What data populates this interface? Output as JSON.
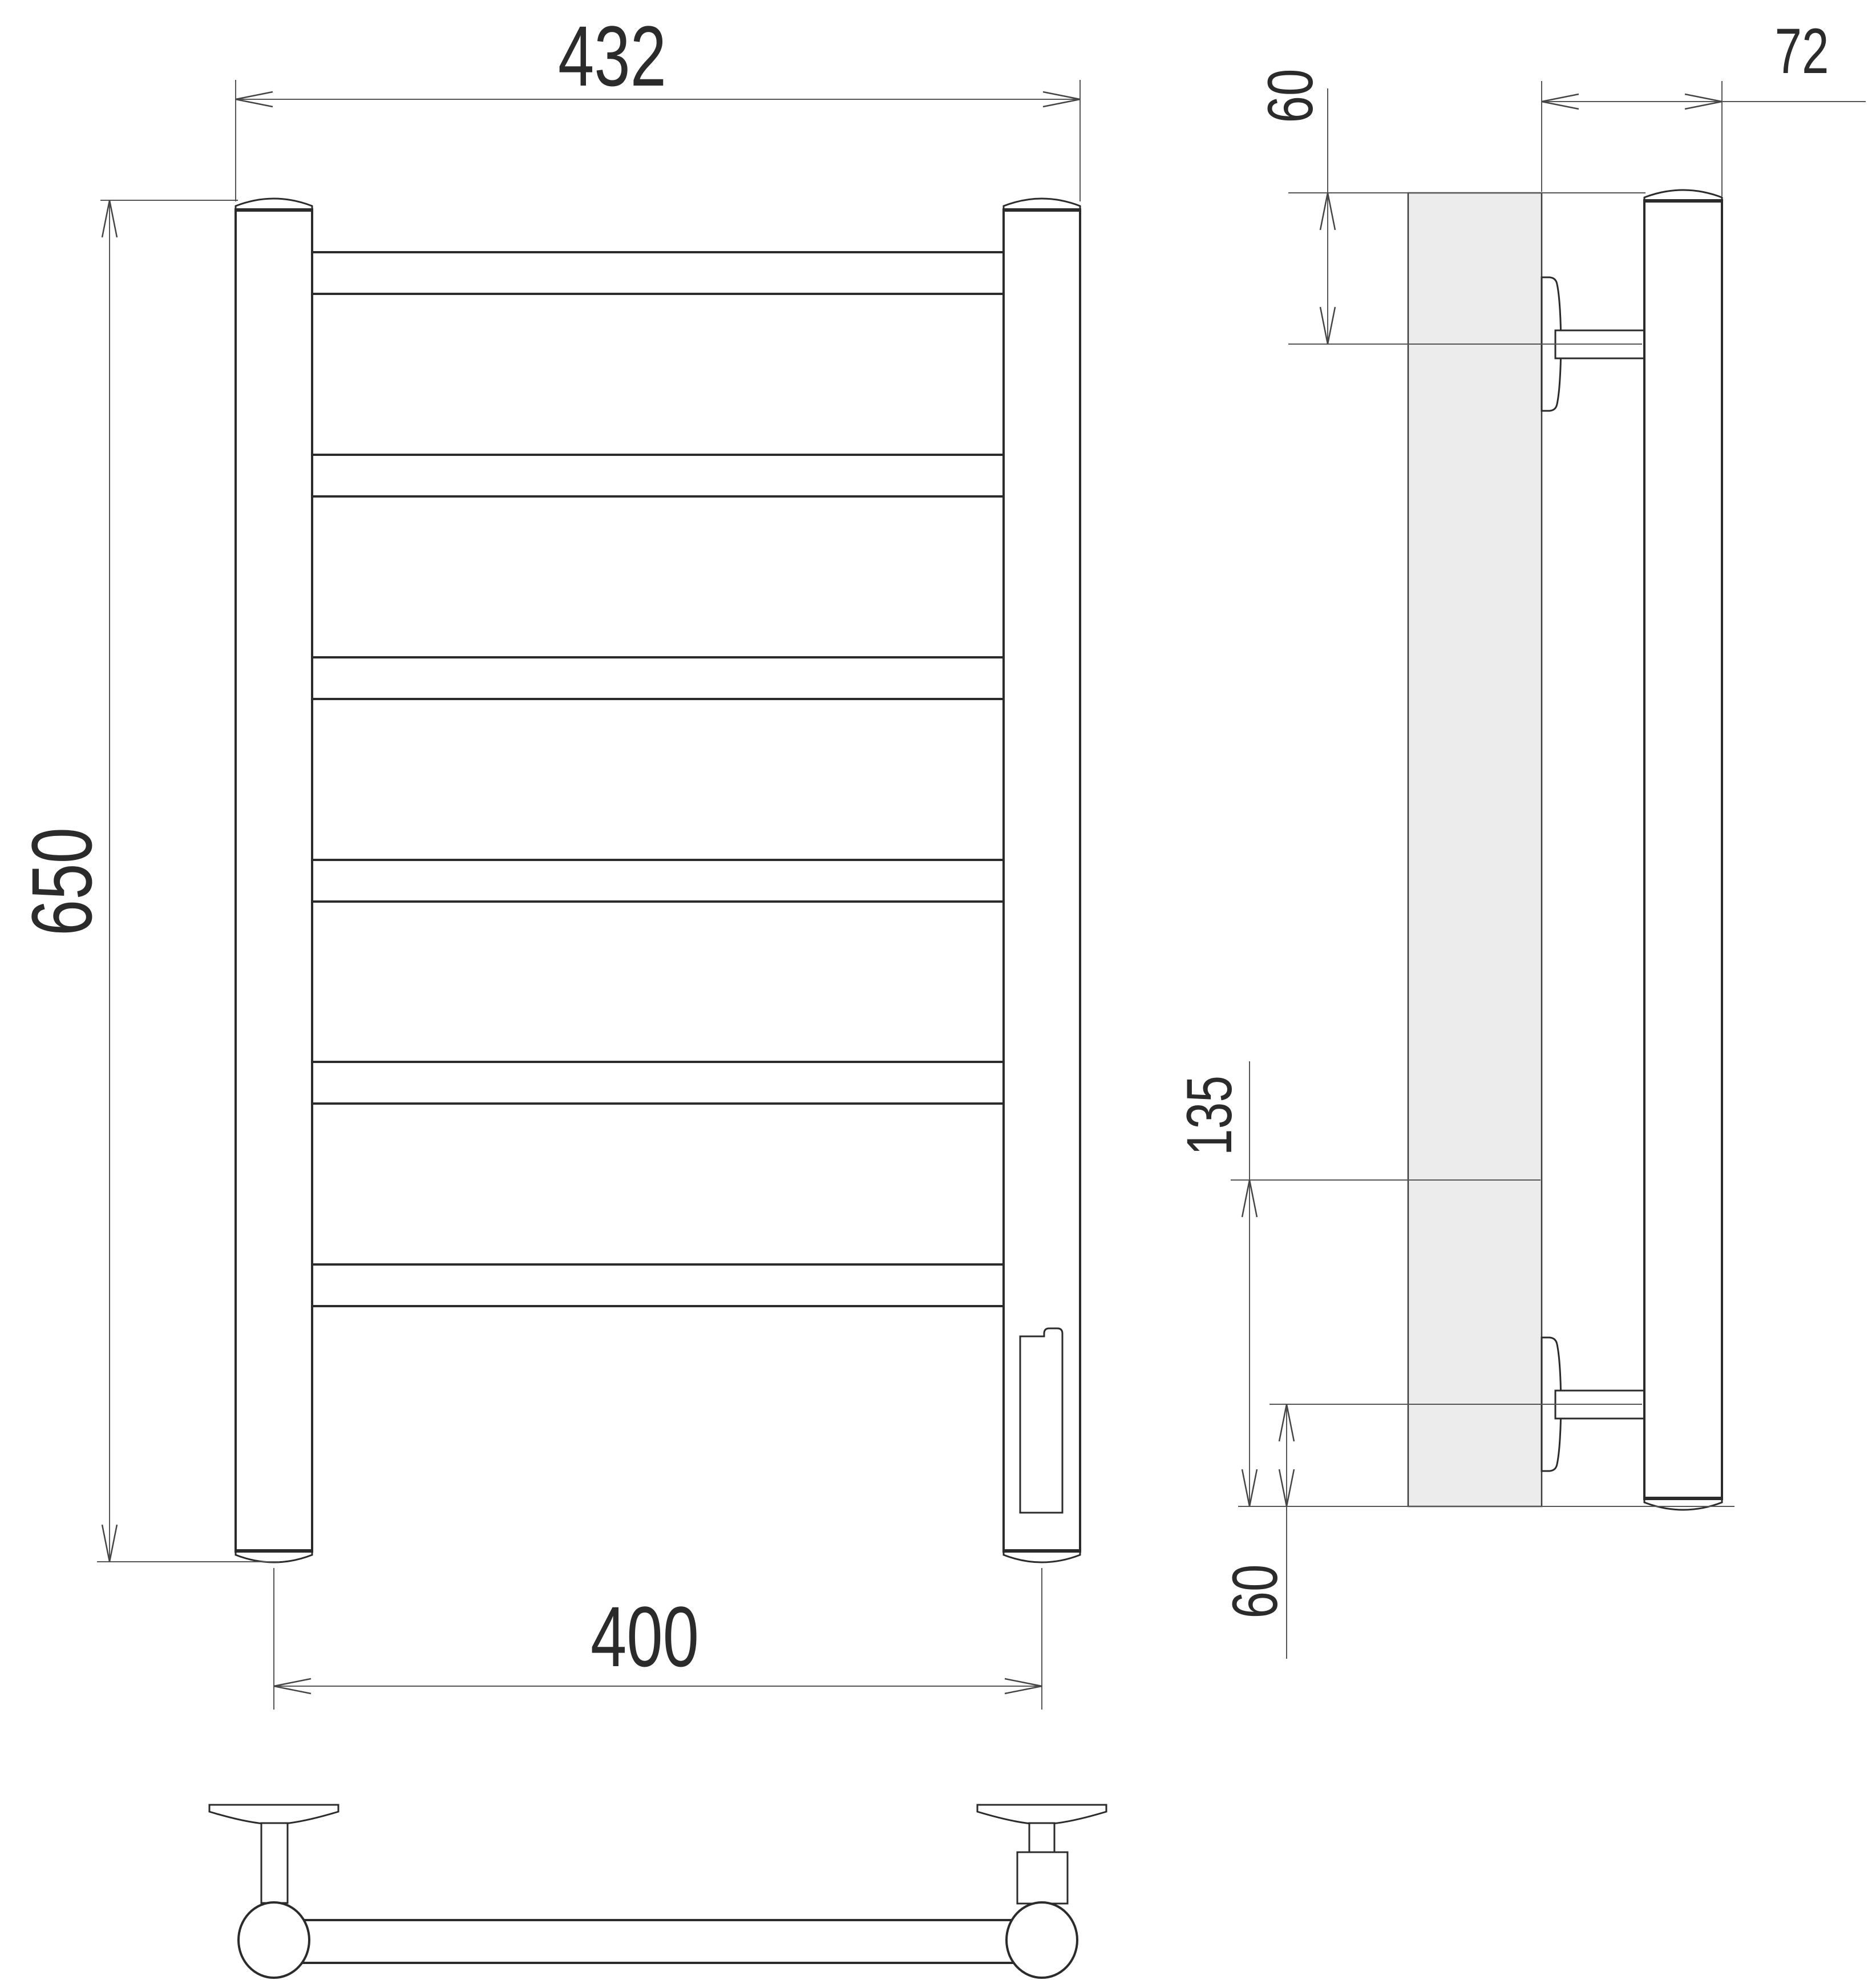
{
  "colors": {
    "background": "#ffffff",
    "object_line": "#2b2b2b",
    "dimension_line": "#555555",
    "wall_fill": "#ececec"
  },
  "labels": {
    "front_overall_width": "432",
    "front_overall_height": "650",
    "front_axis_width": "400",
    "side_depth": "72",
    "side_top_offset": "60",
    "side_lower_span": "135",
    "side_bottom_offset": "60"
  },
  "figure": {
    "rung_count": 6,
    "view_count": 3
  }
}
